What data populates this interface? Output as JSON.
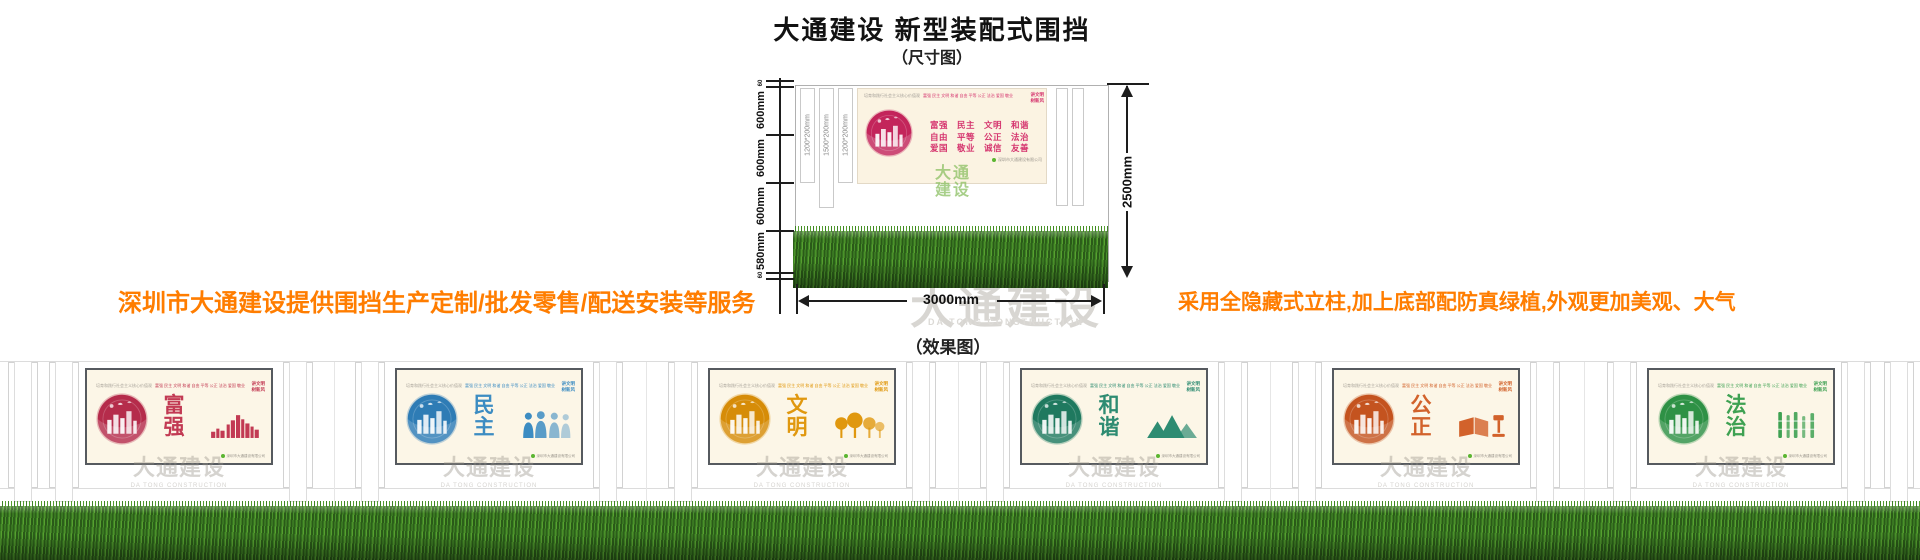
{
  "header": {
    "title": "大通建设 新型装配式围挡",
    "size_label": "（尺寸图）",
    "effect_label": "（效果图）"
  },
  "notes": {
    "left": "深圳市大通建设提供围挡生产定制/批发零售/配送安装等服务",
    "right": "采用全隐藏式立柱,加上底部配防真绿植,外观更加美观、大气",
    "color": "#FF7D00"
  },
  "dimensions": {
    "left_segments": [
      "60",
      "600mm",
      "600mm",
      "600mm",
      "580mm",
      "60"
    ],
    "post_labels": [
      "1200*200mm",
      "1500*200mm",
      "1200*200mm"
    ],
    "overall_height": "2500mm",
    "overall_width": "3000mm"
  },
  "sample_panel": {
    "top_slogan": "培育和践行社会主义核心价值观",
    "values_inline": "富强 民主 文明 和谐 自由 平等 公正 法治 爱国 敬业 诚信 友善",
    "corner_line1": "讲文明",
    "corner_line2": "树新风",
    "values_row1": "富强　民主　文明　和谐",
    "values_row2": "自由　平等　公正　法治",
    "values_row3": "爱国　敬业　诚信　友善",
    "footer_note": "深圳市大通建设有限公司"
  },
  "watermark": {
    "cn": "大通建设",
    "en": "DA TONG CONSTRUCTION",
    "green_line1": "大通",
    "green_line2": "建设"
  },
  "effect": {
    "panels": [
      {
        "word": "富强",
        "color": "#C23A53",
        "circle_color": "#B52C4B",
        "motif": "skyline"
      },
      {
        "word": "民主",
        "color": "#3C8CC2",
        "circle_color": "#2E7CB5",
        "motif": "people"
      },
      {
        "word": "文明",
        "color": "#E0980F",
        "circle_color": "#D68C08",
        "motif": "trees"
      },
      {
        "word": "和谐",
        "color": "#2E8C72",
        "circle_color": "#1F795F",
        "motif": "mountains"
      },
      {
        "word": "公正",
        "color": "#D2622B",
        "circle_color": "#C4531F",
        "motif": "book-gavel"
      },
      {
        "word": "法治",
        "color": "#3EA152",
        "circle_color": "#2E9145",
        "motif": "bamboo"
      }
    ]
  }
}
